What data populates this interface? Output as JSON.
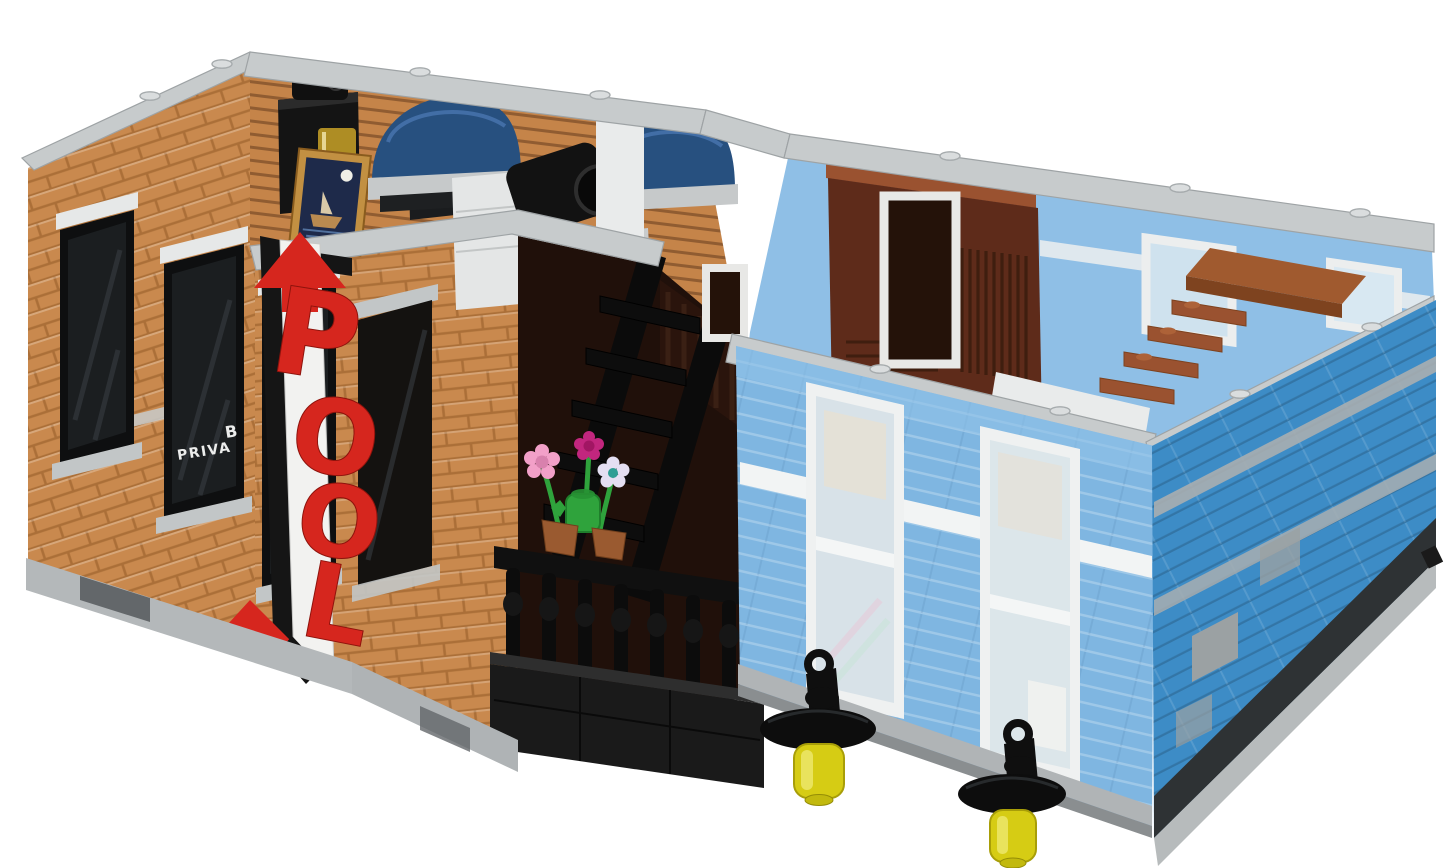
{
  "scene": {
    "background": "#ffffff"
  },
  "pool_sign": {
    "letters": [
      "P",
      "O",
      "O",
      "L"
    ],
    "letter_color": "#d6261e",
    "pole_color": "#f2f2f0",
    "bracket_color": "#151515"
  },
  "window_decal": {
    "line1": "B",
    "line2": "PRIVA"
  },
  "palette": {
    "brick": "#c9894e",
    "interior_wall": "#c58449",
    "cap_gray": "#c7cbcc",
    "cap_white": "#e9ebeb",
    "window_dark": "#1b1e20",
    "frame_black": "#0e0f10",
    "lintel_white": "#e6e8e8",
    "sill_gray": "#c2c6c7",
    "awning_blue": "#27507f",
    "facade_blue": "#7fb6e1",
    "facade_stripe": "#f2f4f4",
    "azure": "#3d8cc6",
    "azure_stripe": "#a8aeb0",
    "panel_red": "#5e2b1a",
    "wood_brown": "#9a5230",
    "ledge_brown": "#a05a2f",
    "balcony_black": "#1a1a1a",
    "flower_pink": "#f2a0c8",
    "flower_magenta": "#c2267e",
    "flower_white": "#e4dff2",
    "flower_center": "#2e9e94",
    "stem_green": "#2fa33c",
    "pot_brown": "#9a5a30",
    "lamp_black": "#0f0f0f",
    "lamp_yellow": "#d6cc14",
    "lamp_yellow_hi": "#ece66a",
    "base_gray": "#b4b8ba",
    "base_dark": "#2e3234",
    "interior_blue": "#8fbfe6",
    "frame_gold": "#c29042",
    "night_navy": "#1e2a4a",
    "desk_white": "#e4e6e6",
    "gold": "#c9a227"
  }
}
